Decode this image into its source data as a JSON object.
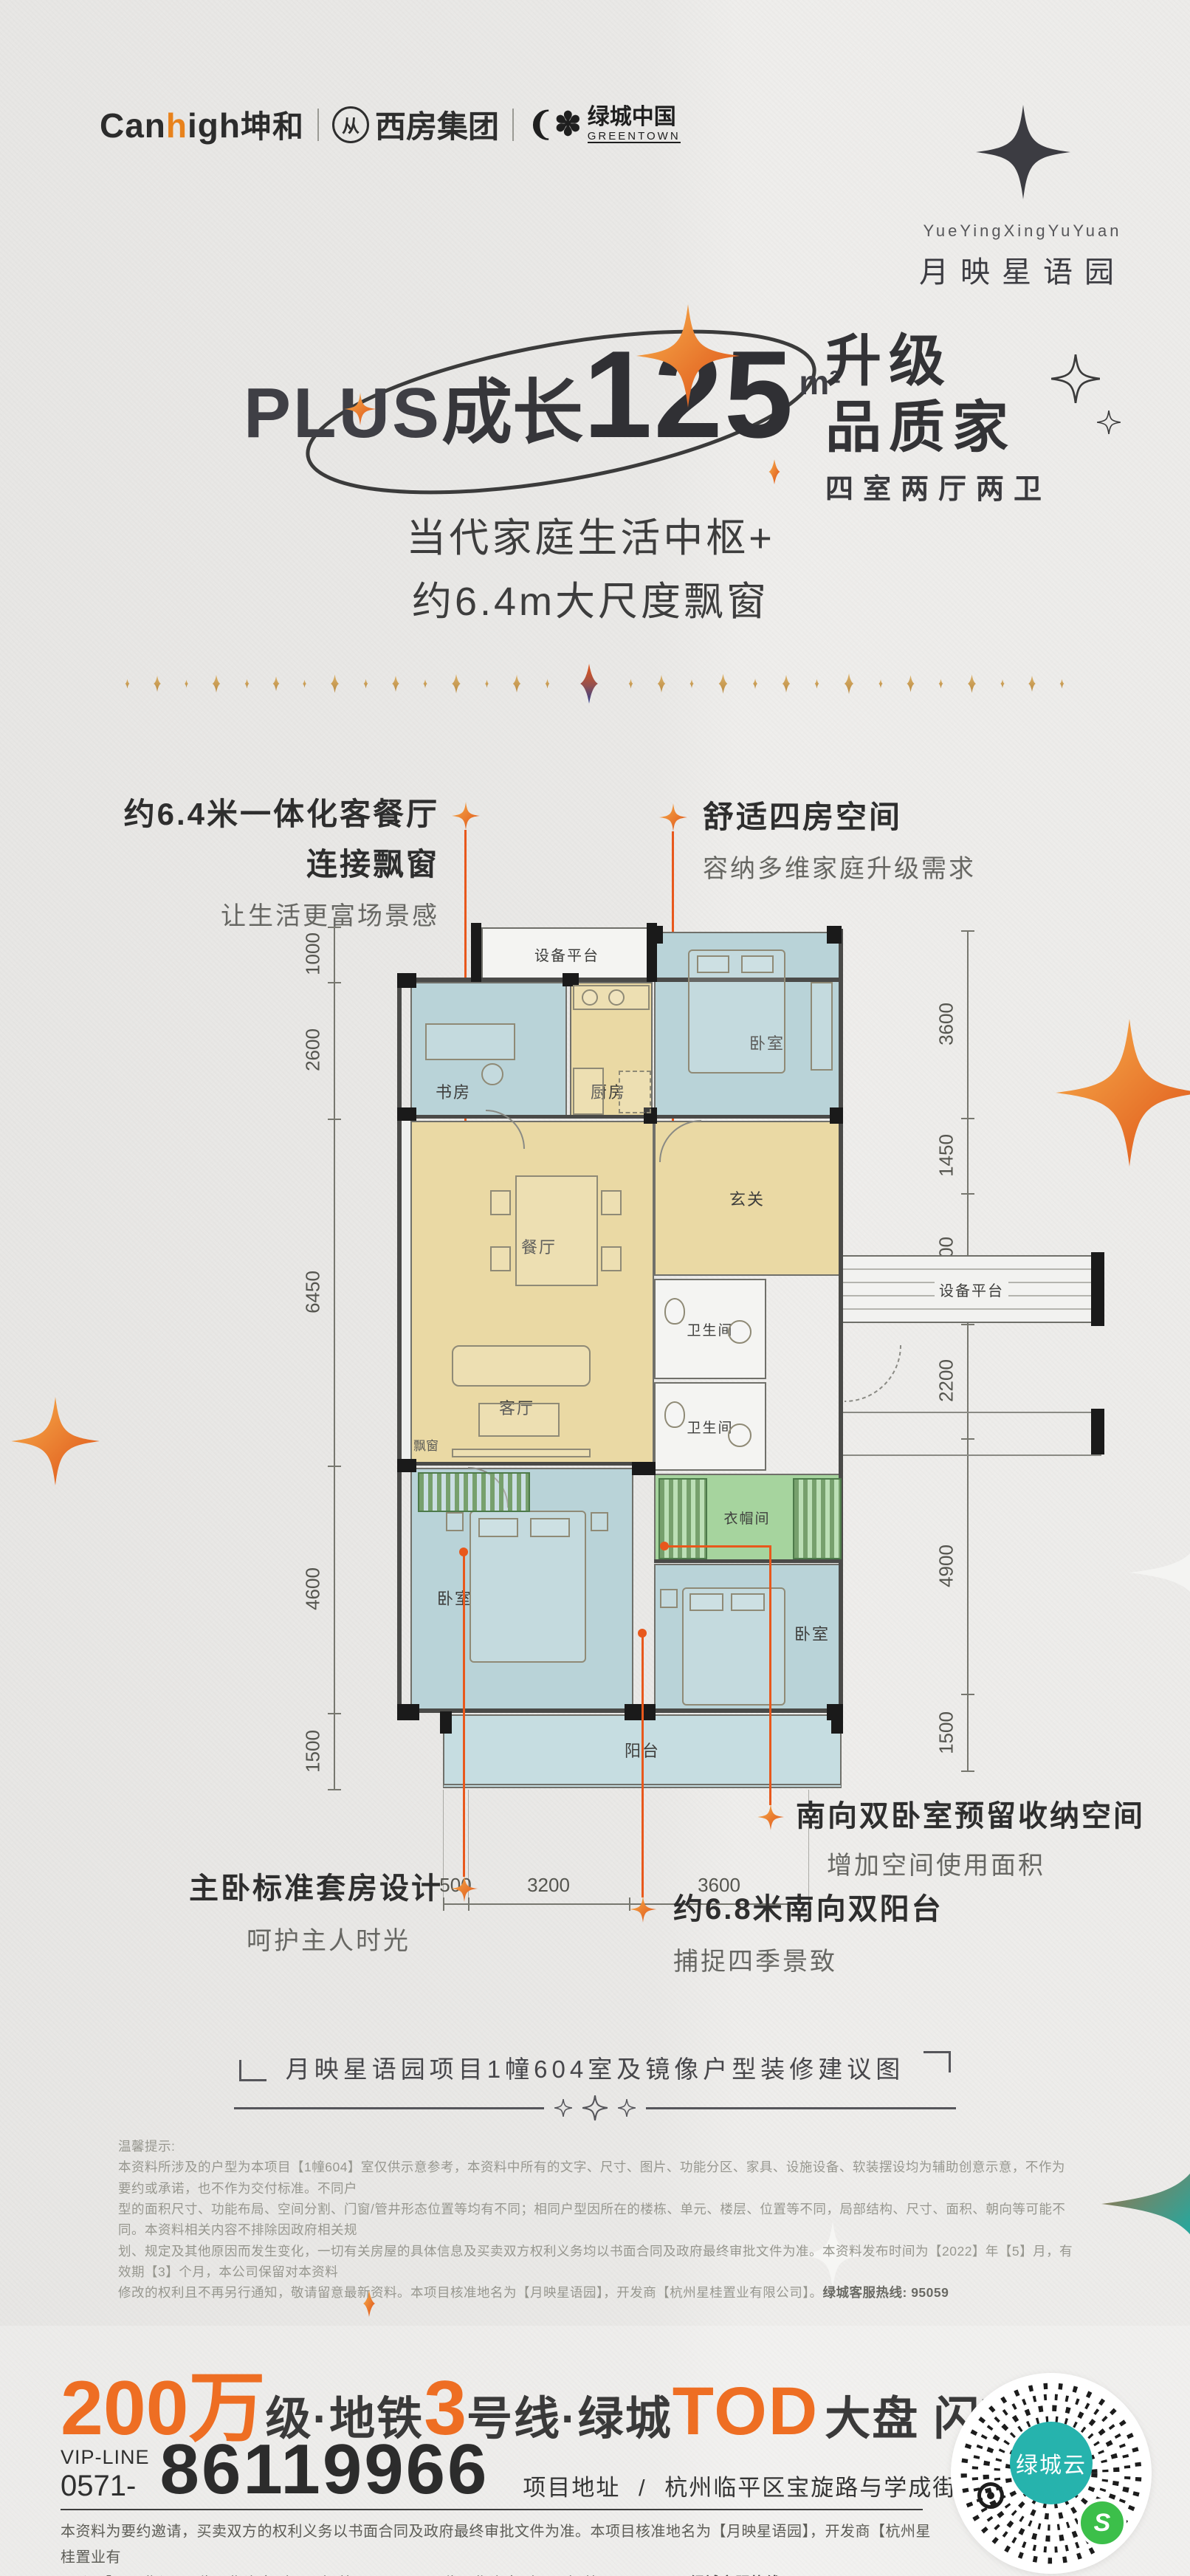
{
  "header": {
    "brand1_pre": "Can",
    "brand1_accent": "h",
    "brand1_post": "igh",
    "brand1_cn": "坤和",
    "brand2": "西房集团",
    "brand3_cn": "绿城中国",
    "brand3_en": "GREENTOWN",
    "logo_en": "YueYingXingYuYuan",
    "logo_cn": "月映星语园"
  },
  "hero": {
    "plus": "PLUS",
    "grow": "成长",
    "num": "125",
    "unit": "m²",
    "right1": "升级",
    "right2": "品质家",
    "right_sub": "四室两厅两卫",
    "sub1": "当代家庭生活中枢+",
    "sub2": "约6.4m大尺度飘窗"
  },
  "plan": {
    "rooms": {
      "equip": "设备平台",
      "bedroom": "卧室",
      "study": "书房",
      "kitchen": "厨房",
      "dining": "餐厅",
      "living": "客厅",
      "bay": "飘窗",
      "hall": "玄关",
      "bath": "卫生间",
      "closet": "衣帽间",
      "balcony": "阳台"
    },
    "dims": {
      "top": [
        "2350",
        "2650",
        "2800"
      ],
      "left": [
        "1000",
        "2600",
        "6450",
        "4600",
        "1500"
      ],
      "right": [
        "3600",
        "1450",
        "2500",
        "2200",
        "4900",
        "1500"
      ],
      "bottom": [
        "500",
        "3200",
        "3600"
      ]
    },
    "ann1_l1": "约6.4米一体化客餐厅",
    "ann1_l2": "连接飘窗",
    "ann1_l3": "让生活更富场景感",
    "ann2_l1": "舒适四房空间",
    "ann2_l2": "容纳多维家庭升级需求",
    "ann3_l1": "南向双卧室预留收纳空间",
    "ann3_l2": "增加空间使用面积",
    "ann4_l1": "约6.8米南向双阳台",
    "ann4_l2": "捕捉四季景致",
    "ann5_l1": "主卧标准套房设计",
    "ann5_l2": "呵护主人时光"
  },
  "caption": "月映星语园项目1幢604室及镜像户型装修建议图",
  "notice": {
    "label": "温馨提示:",
    "l1": "本资料所涉及的户型为本项目【1幢604】室仅供示意参考，本资料中所有的文字、尺寸、图片、功能分区、家具、设施设备、软装摆设均为辅助创意示意，不作为要约或承诺，也不作为交付标准。不同户",
    "l2": "型的面积尺寸、功能布局、空间分割、门窗/管井形态位置等均有不同；相同户型因所在的楼栋、单元、楼层、位置等不同，局部结构、尺寸、面积、朝向等可能不同。本资料相关内容不排除因政府相关规",
    "l3": "划、规定及其他原因而发生变化，一切有关房屋的具体信息及买卖双方权利义务均以书面合同及政府最终审批文件为准。本资料发布时间为【2022】年【5】月，有效期【3】个月，本公司保留对本资料",
    "l4": "修改的权利且不再另行通知，敬请留意最新资料。本项目核准地名为【月映星语园】，开发商【杭州星桂置业有限公司】。",
    "l4_bold": "绿城客服热线: 95059"
  },
  "footer": {
    "h1": "200万",
    "h2": "级·地铁",
    "h3": "3",
    "h4": "号线·绿城",
    "h5": "TOD",
    "h6": "大盘 闪耀加推",
    "vip_label": "VIP-LINE",
    "vip_prefix": "0571-",
    "phone": "86119966",
    "addr_label": "项目地址",
    "addr_sep": "/",
    "addr": "杭州临平区宝旋路与学成街交叉口东侧",
    "legal1": "本资料为要约邀请，买卖双方的权利义务以书面合同及政府最终审批文件为准。本项目核准地名为【月映星语园】，开发商【杭州星桂置业有",
    "legal2": "限公司】，预售证号: 临平售许字（2022）第ZJ00139号，临平售许字（2022）第ZJ00175号。",
    "legal2_bold": "绿城客服热线:95059",
    "qr_center": "绿城云"
  },
  "colors": {
    "accent_orange": "#e8581c",
    "gold": "#c9a05c",
    "teal": "#26b3ad",
    "mini_green": "#3cbf4a"
  }
}
